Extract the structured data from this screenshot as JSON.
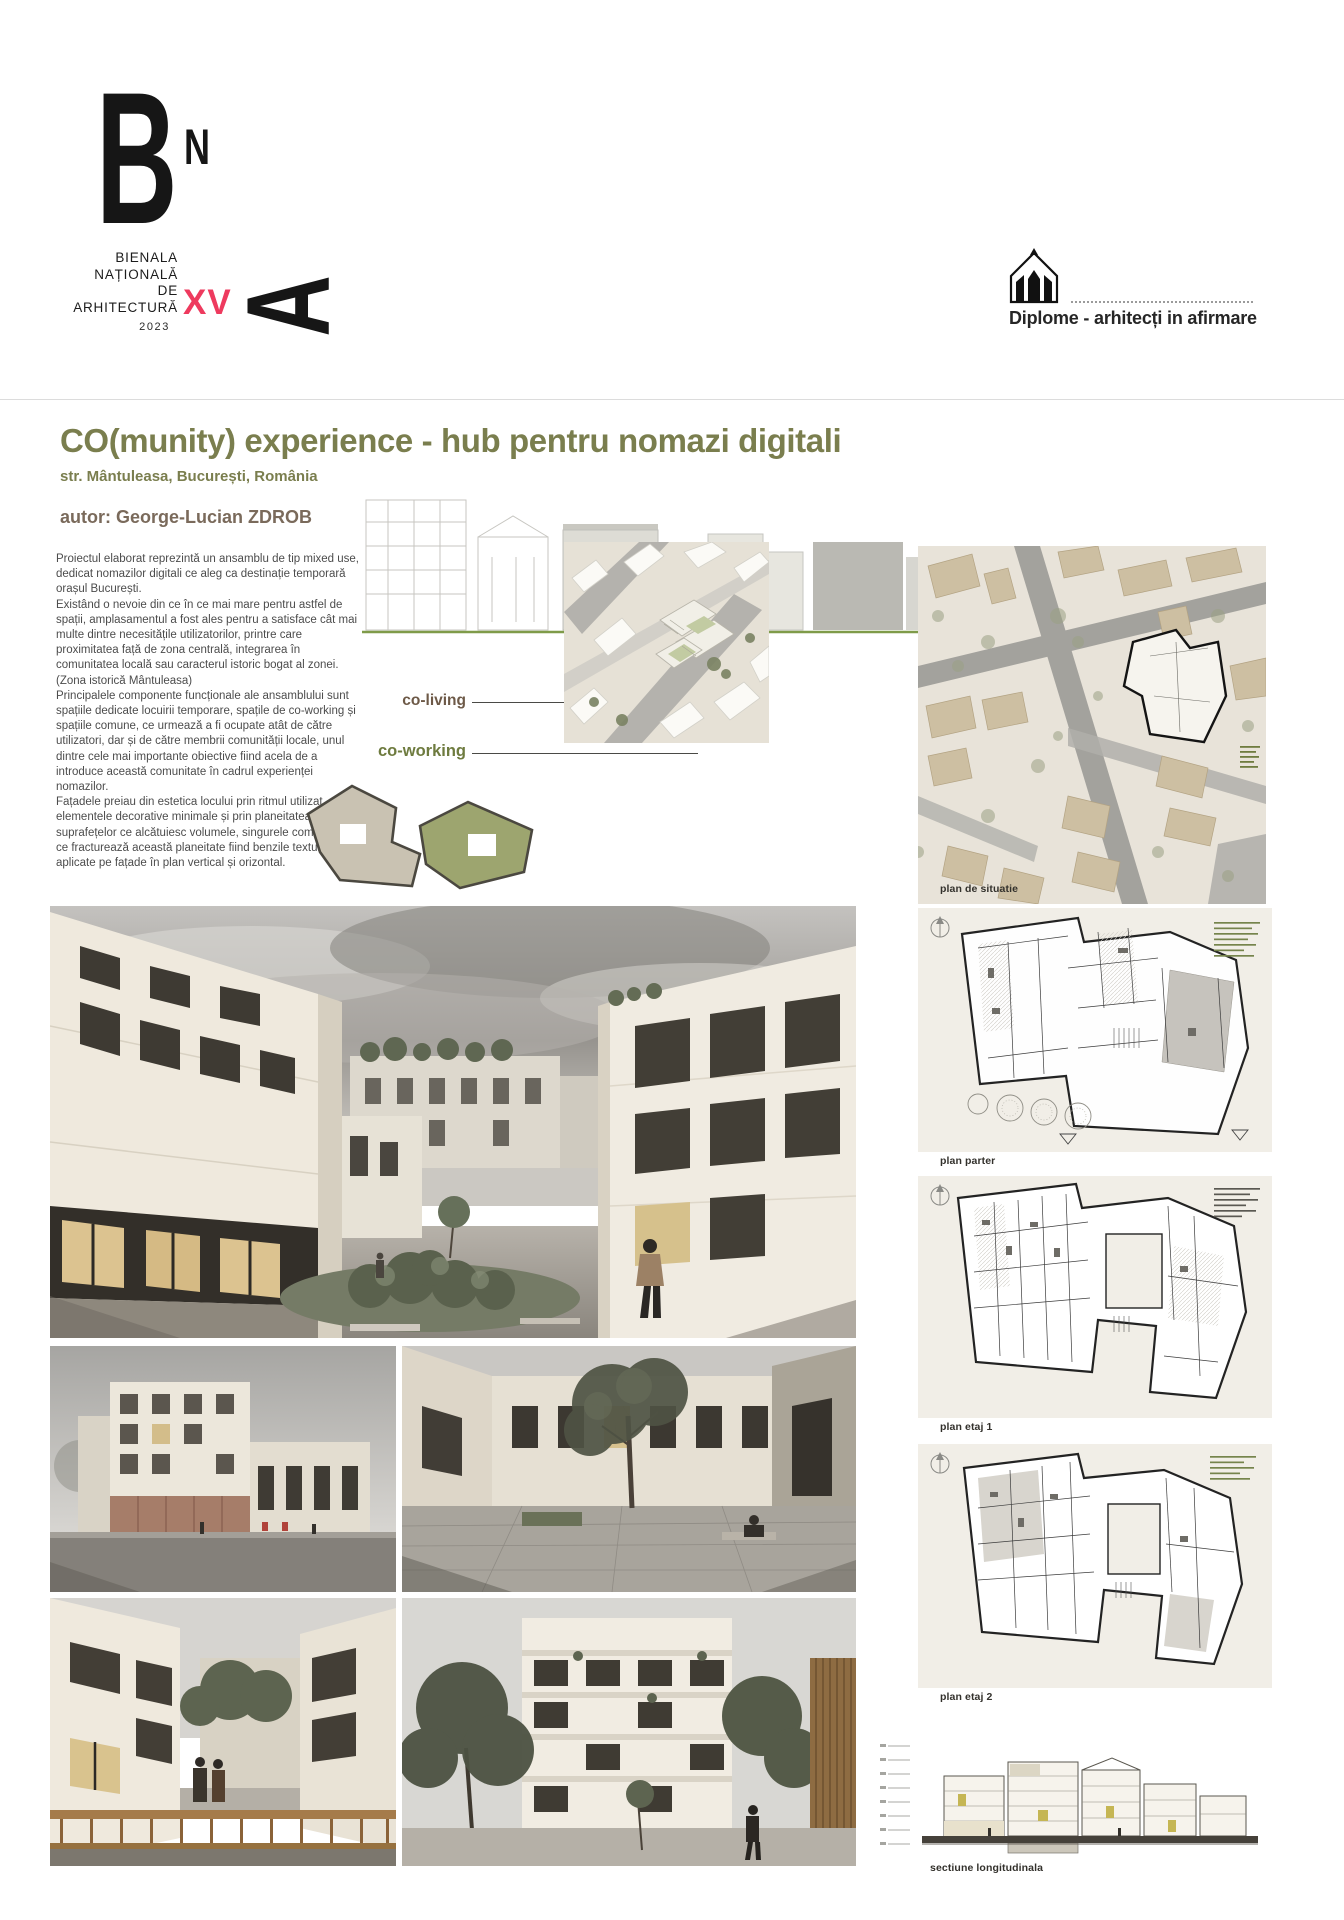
{
  "header": {
    "logo": {
      "letter_b": "B",
      "letter_n": "N",
      "letter_a": "A",
      "lines": [
        "BIENALA",
        "NAȚIONALĂ",
        "DE",
        "ARHITECTURĂ"
      ],
      "edition": "XV",
      "year": "2023"
    },
    "program_label": "Diplome - arhitecți in afirmare"
  },
  "project": {
    "title": "CO(munity) experience - hub pentru nomazi digitali",
    "location": "str. Mântuleasa, București, România",
    "author": "autor: George-Lucian ZDROB",
    "description": "Proiectul elaborat reprezintă un ansamblu de tip mixed use, dedicat nomazilor digitali ce aleg ca destinație temporară orașul București.\nExistând o nevoie din ce în ce mai mare pentru astfel de spații, amplasamentul a fost ales pentru a satisface cât mai multe dintre necesitățile utilizatorilor, printre care proximitatea față de zona centrală, integrarea în comunitatea locală sau caracterul istoric bogat al zonei. (Zona istorică Mântuleasa)\nPrincipalele componente funcționale ale ansamblului sunt spațiile dedicate locuirii temporare, spațile de co-working și spațiile comune, ce urmează a fi ocupate atât de către utilizatori, dar și de către membrii comunității locale, unul dintre cele mai importante obiective fiind acela de a introduce această comunitate în cadrul experienței nomazilor.\nFațadele preiau din estetica locului prin ritmul utilizat, prin elementele decorative minimale și prin planeitatea suprafețelor ce alcătuiesc volumele, singurele componente ce fracturează această planeitate fiind benzile texturate aplicate pe fațade în plan vertical și orizontal."
  },
  "diagram": {
    "co_living": "co-living",
    "co_working": "co-working"
  },
  "captions": {
    "site_plan": "plan de situatie",
    "ground_floor_plan": "plan parter",
    "floor_1_plan": "plan etaj 1",
    "floor_2_plan": "plan etaj 2",
    "longitudinal_section": "sectiune longitudinala"
  },
  "colors": {
    "title_olive": "#7a7e4e",
    "edition_pink": "#ee3a5e",
    "author_brown": "#7a6a5b",
    "co_living_brown": "#6d5947",
    "co_working_olive": "#6e7b3f",
    "body_text": "#4c4c4c"
  }
}
